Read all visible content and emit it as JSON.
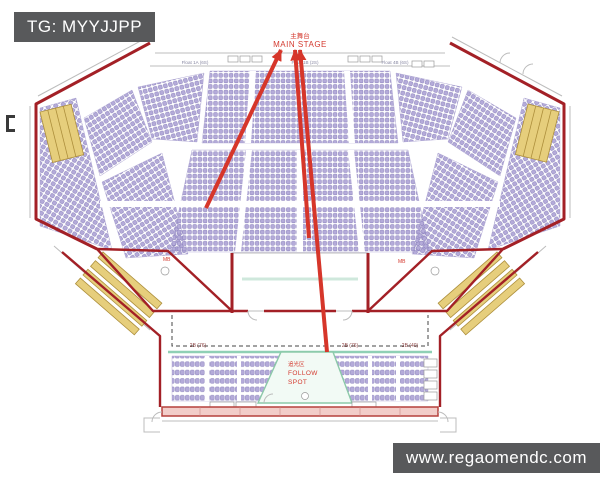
{
  "badges": {
    "tag": "TG: MYYJJPP",
    "watermark": "www.regaomendc.com"
  },
  "stage": {
    "label_cn": "主舞台",
    "label_en": "MAIN STAGE"
  },
  "follow_spot": {
    "label_cn": "追光区",
    "line1": "FOLLOW",
    "line2": "SPOT"
  },
  "section_labels": {
    "float_left": "Float 1A (6S)",
    "float_center": "Float 1B (2S)",
    "float_right": "Float 4B (6S)",
    "row_left": "2B (76)",
    "row_mid": "2B (76)",
    "row_right": "2B (40)",
    "ramp_left": "MB",
    "ramp_right": "MB"
  },
  "colors": {
    "badge": "#58595b",
    "outline": "#a32026",
    "arrow": "#d6362a",
    "seat": "#b4abd9",
    "seat_stroke": "#7e74b4",
    "yellow": "#e6ce7c",
    "yellow_stroke": "#ad8f3c",
    "green": "#8fd0b5",
    "cyan": "#cfe8dc",
    "wall_fill": "#f2cdc9",
    "wall_red": "#b5403c",
    "text_red": "#d43a2f",
    "row_label": "#8a4040"
  }
}
